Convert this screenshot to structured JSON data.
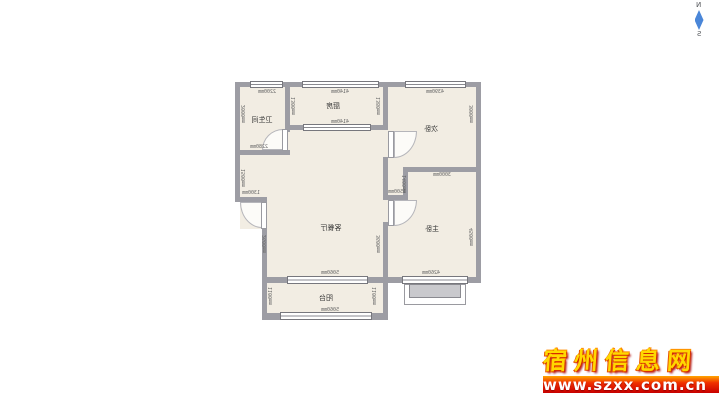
{
  "compass": {
    "north": "N",
    "south": "S",
    "arrow_color": "#4a86d8"
  },
  "watermark": {
    "site_name": "宿州信息网",
    "url": "www.szxx.com.cn"
  },
  "floor_plan": {
    "text_mirrored": true,
    "colors": {
      "wall": "#9d9da4",
      "room_fill": "#f2ede3",
      "dimension_text": "#666666",
      "label_text": "#333333"
    },
    "rooms": [
      {
        "name": "卫生间",
        "x": 27,
        "y": 38
      },
      {
        "name": "厨房",
        "x": 98,
        "y": 24
      },
      {
        "name": "次卧",
        "x": 196,
        "y": 47
      },
      {
        "name": "客餐厅",
        "x": 96,
        "y": 146
      },
      {
        "name": "主卧",
        "x": 197,
        "y": 147
      },
      {
        "name": "阳台",
        "x": 91,
        "y": 216
      }
    ],
    "dimensions": [
      {
        "text": "2200mm",
        "x": 32,
        "y": 10,
        "v": false
      },
      {
        "text": "4140mm",
        "x": 105,
        "y": 10,
        "v": false
      },
      {
        "text": "4390mm",
        "x": 200,
        "y": 10,
        "v": false
      },
      {
        "text": "2000mm",
        "x": 9,
        "y": 32,
        "v": true
      },
      {
        "text": "1300mm",
        "x": 59,
        "y": 24,
        "v": true
      },
      {
        "text": "2280mm",
        "x": 24,
        "y": 65,
        "v": false
      },
      {
        "text": "4140mm",
        "x": 105,
        "y": 40,
        "v": false
      },
      {
        "text": "1380mm",
        "x": 144,
        "y": 24,
        "v": true
      },
      {
        "text": "3000mm",
        "x": 237,
        "y": 32,
        "v": true
      },
      {
        "text": "3000mm",
        "x": 207,
        "y": 93,
        "v": false
      },
      {
        "text": "1400mm",
        "x": 170,
        "y": 102,
        "v": true
      },
      {
        "text": "1500mm",
        "x": 162,
        "y": 110,
        "v": false
      },
      {
        "text": "1500mm",
        "x": 9,
        "y": 96,
        "v": true
      },
      {
        "text": "1300mm",
        "x": 16,
        "y": 111,
        "v": false
      },
      {
        "text": "2600mm",
        "x": 30,
        "y": 162,
        "v": true
      },
      {
        "text": "3600mm",
        "x": 144,
        "y": 162,
        "v": true
      },
      {
        "text": "5060mm",
        "x": 95,
        "y": 191,
        "v": false
      },
      {
        "text": "1100mm",
        "x": 36,
        "y": 214,
        "v": true
      },
      {
        "text": "1100mm",
        "x": 140,
        "y": 214,
        "v": true
      },
      {
        "text": "5060mm",
        "x": 95,
        "y": 228,
        "v": false
      },
      {
        "text": "4260mm",
        "x": 196,
        "y": 191,
        "v": false
      },
      {
        "text": "4500mm",
        "x": 237,
        "y": 155,
        "v": true
      }
    ]
  }
}
